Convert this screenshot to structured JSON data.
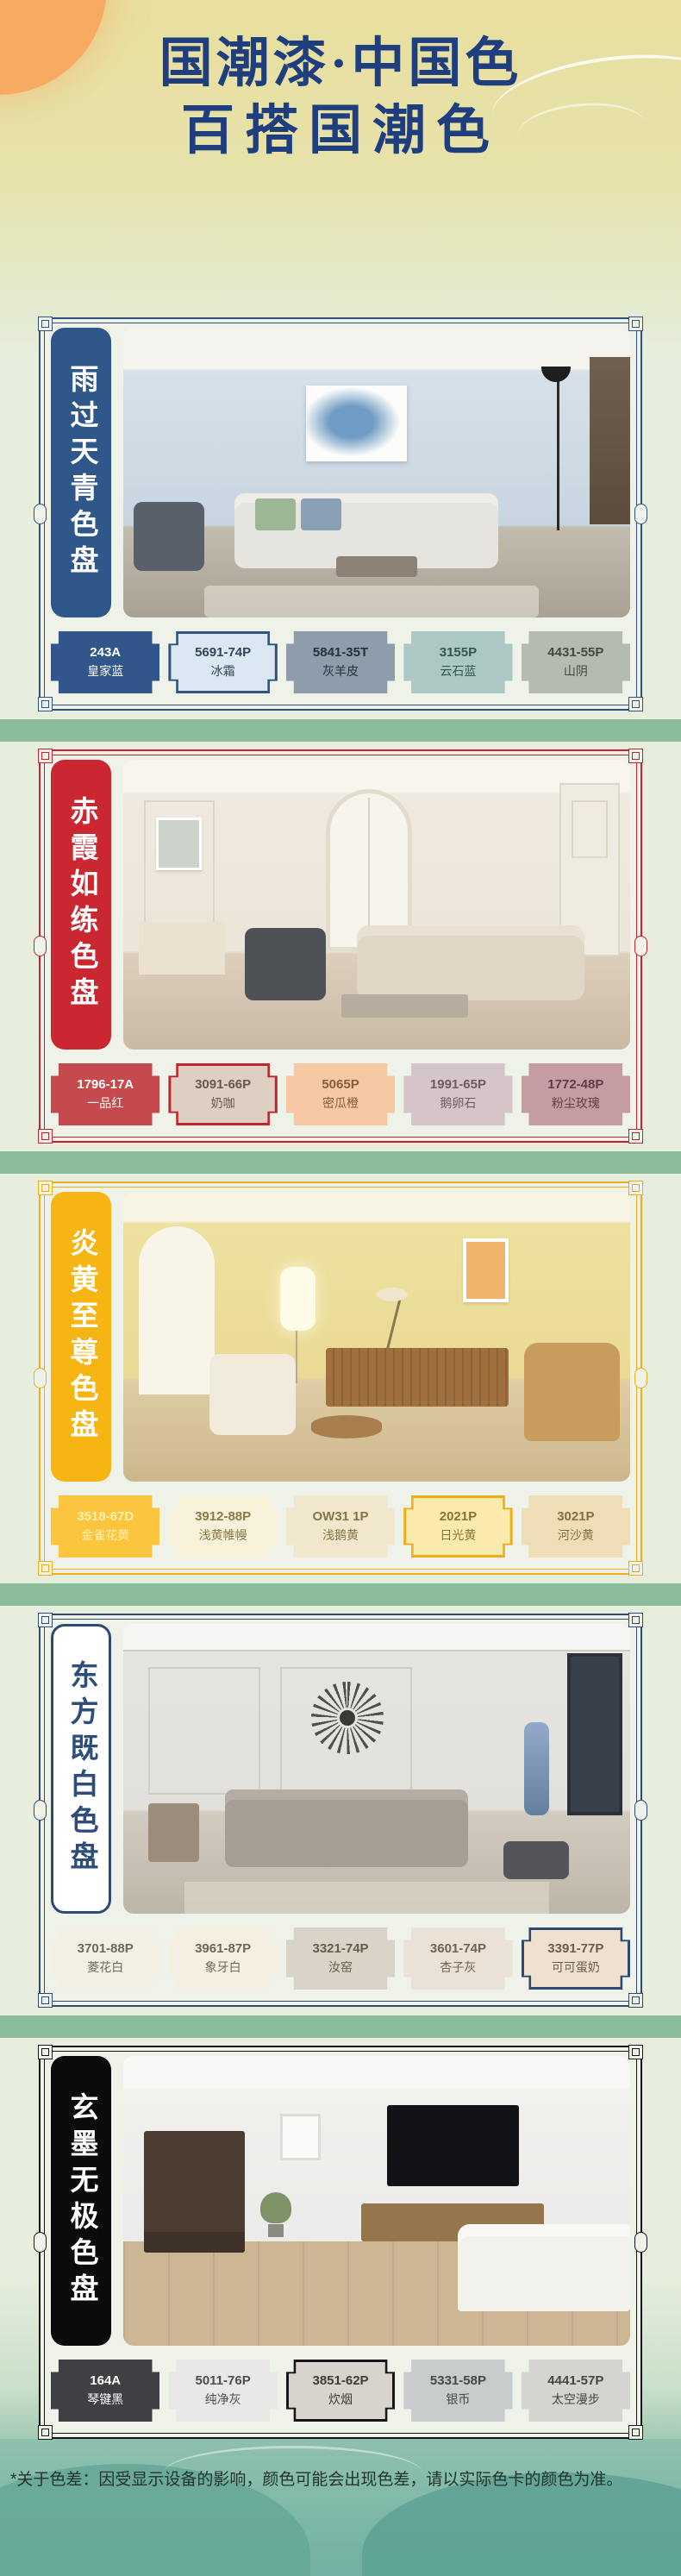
{
  "page": {
    "title_line1": "国潮漆·中国色",
    "title_line2": "百搭国潮色",
    "title_color": "#1e3e7e",
    "footer_note": "*关于色差：因受显示设备的影响，颜色可能会出现色差，请以实际色卡的颜色为准。"
  },
  "sections": [
    {
      "title": "雨过天青色盘",
      "accent": "#33517e",
      "banner_bg": "#2f578a",
      "banner_fg": "#ffffff",
      "swatches": [
        {
          "code": "243A",
          "name": "皇家蓝",
          "bg": "#31568c",
          "fg": "#ffffff"
        },
        {
          "code": "5691-74P",
          "name": "冰霜",
          "bg": "#dbe7f2",
          "fg": "#33455a"
        },
        {
          "code": "5841-35T",
          "name": "灰羊皮",
          "bg": "#8e9cac",
          "fg": "#27303c"
        },
        {
          "code": "3155P",
          "name": "云石蓝",
          "bg": "#abc8c5",
          "fg": "#35544f"
        },
        {
          "code": "4431-55P",
          "name": "山阴",
          "bg": "#b4bcb0",
          "fg": "#3f4a3f"
        }
      ]
    },
    {
      "title": "赤霞如练色盘",
      "accent": "#c5242c",
      "banner_bg": "#cb2731",
      "banner_fg": "#ffffff",
      "swatches": [
        {
          "code": "1796-17A",
          "name": "一品红",
          "bg": "#c54a4d",
          "fg": "#ffffff"
        },
        {
          "code": "3091-66P",
          "name": "奶咖",
          "bg": "#ddcfc1",
          "fg": "#6a564a"
        },
        {
          "code": "5065P",
          "name": "密瓜橙",
          "bg": "#f7c8a4",
          "fg": "#8a5a3a"
        },
        {
          "code": "1991-65P",
          "name": "鹅卵石",
          "bg": "#d6c5c8",
          "fg": "#6e5a5e"
        },
        {
          "code": "1772-48P",
          "name": "粉尘玫瑰",
          "bg": "#c69ca3",
          "fg": "#5e3e44"
        }
      ]
    },
    {
      "title": "炎黄至尊色盘",
      "accent": "#efae18",
      "banner_bg": "#f6b513",
      "banner_fg": "#ffffff",
      "swatches": [
        {
          "code": "3518-67D",
          "name": "金雀花黄",
          "bg": "#fbc53e",
          "fg": "#fdf0b2"
        },
        {
          "code": "3912-88P",
          "name": "浅黄帷幔",
          "bg": "#f8f1d9",
          "fg": "#8a7a4a"
        },
        {
          "code": "OW31 1P",
          "name": "浅鹅黄",
          "bg": "#f1e7cd",
          "fg": "#857448"
        },
        {
          "code": "2021P",
          "name": "日光黄",
          "bg": "#fbeaae",
          "fg": "#8a7434"
        },
        {
          "code": "3021P",
          "name": "河沙黄",
          "bg": "#efddb6",
          "fg": "#827047"
        }
      ]
    },
    {
      "title": "东方既白色盘",
      "accent": "#2e4a74",
      "banner_bg": "#ffffff",
      "banner_fg": "#2e4d7b",
      "swatches": [
        {
          "code": "3701-88P",
          "name": "菱花白",
          "bg": "#f2f0e5",
          "fg": "#6c6a58"
        },
        {
          "code": "3961-87P",
          "name": "象牙白",
          "bg": "#f4efe1",
          "fg": "#6e6850"
        },
        {
          "code": "3321-74P",
          "name": "汝窑",
          "bg": "#dad3c7",
          "fg": "#645c4c"
        },
        {
          "code": "3601-74P",
          "name": "杏子灰",
          "bg": "#eae2d6",
          "fg": "#6e6454"
        },
        {
          "code": "3391-77P",
          "name": "可可蛋奶",
          "bg": "#eee1d0",
          "fg": "#6e5c48"
        }
      ]
    },
    {
      "title": "玄墨无极色盘",
      "accent": "#17171a",
      "banner_bg": "#0b0b0e",
      "banner_fg": "#ffffff",
      "swatches": [
        {
          "code": "164A",
          "name": "琴键黑",
          "bg": "#404044",
          "fg": "#ffffff"
        },
        {
          "code": "5011-76P",
          "name": "纯净灰",
          "bg": "#eae8e6",
          "fg": "#4f4d4b"
        },
        {
          "code": "3851-62P",
          "name": "炊烟",
          "bg": "#d8d4cc",
          "fg": "#3e3c38"
        },
        {
          "code": "5331-58P",
          "name": "银币",
          "bg": "#c9cccd",
          "fg": "#44484a"
        },
        {
          "code": "4441-57P",
          "name": "太空漫步",
          "bg": "#d6d4d0",
          "fg": "#474543"
        }
      ]
    }
  ]
}
